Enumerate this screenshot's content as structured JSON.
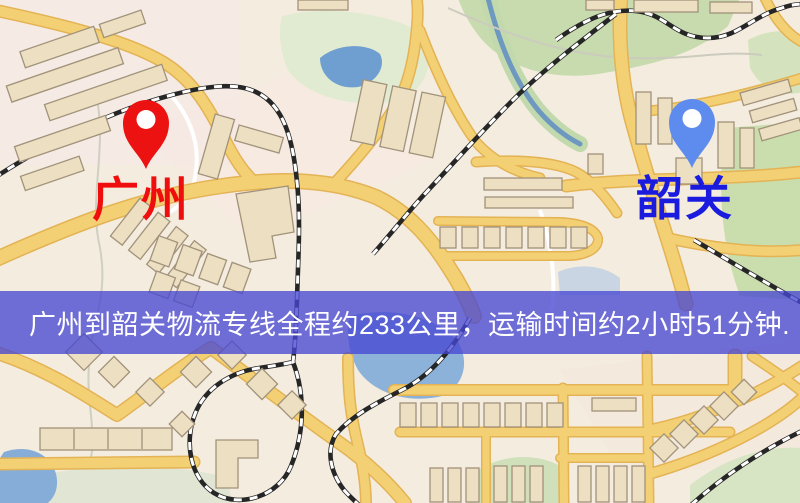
{
  "markers": {
    "origin": {
      "label": "广州",
      "icon": "map-pin",
      "pin_color": "#ec1212",
      "label_color": "#f00d0d"
    },
    "destination": {
      "label": "韶关",
      "icon": "map-pin",
      "pin_color": "#5d8cee",
      "label_color": "#1b1bdf"
    }
  },
  "banner": {
    "text": "广州到韶关物流专线全程约233公里，运输时间约2小时51分钟.",
    "background_color": "#4848d2",
    "text_color": "#ffffff"
  },
  "map_palette": {
    "land": "#f4ecdf",
    "park": "#c7dbae",
    "water": "#6f9ed0",
    "road_fill": "#f4d075",
    "road_casing": "#e3b354",
    "railway": "#262626",
    "building": "#ecdfc2",
    "building_outline": "#a1927a"
  }
}
